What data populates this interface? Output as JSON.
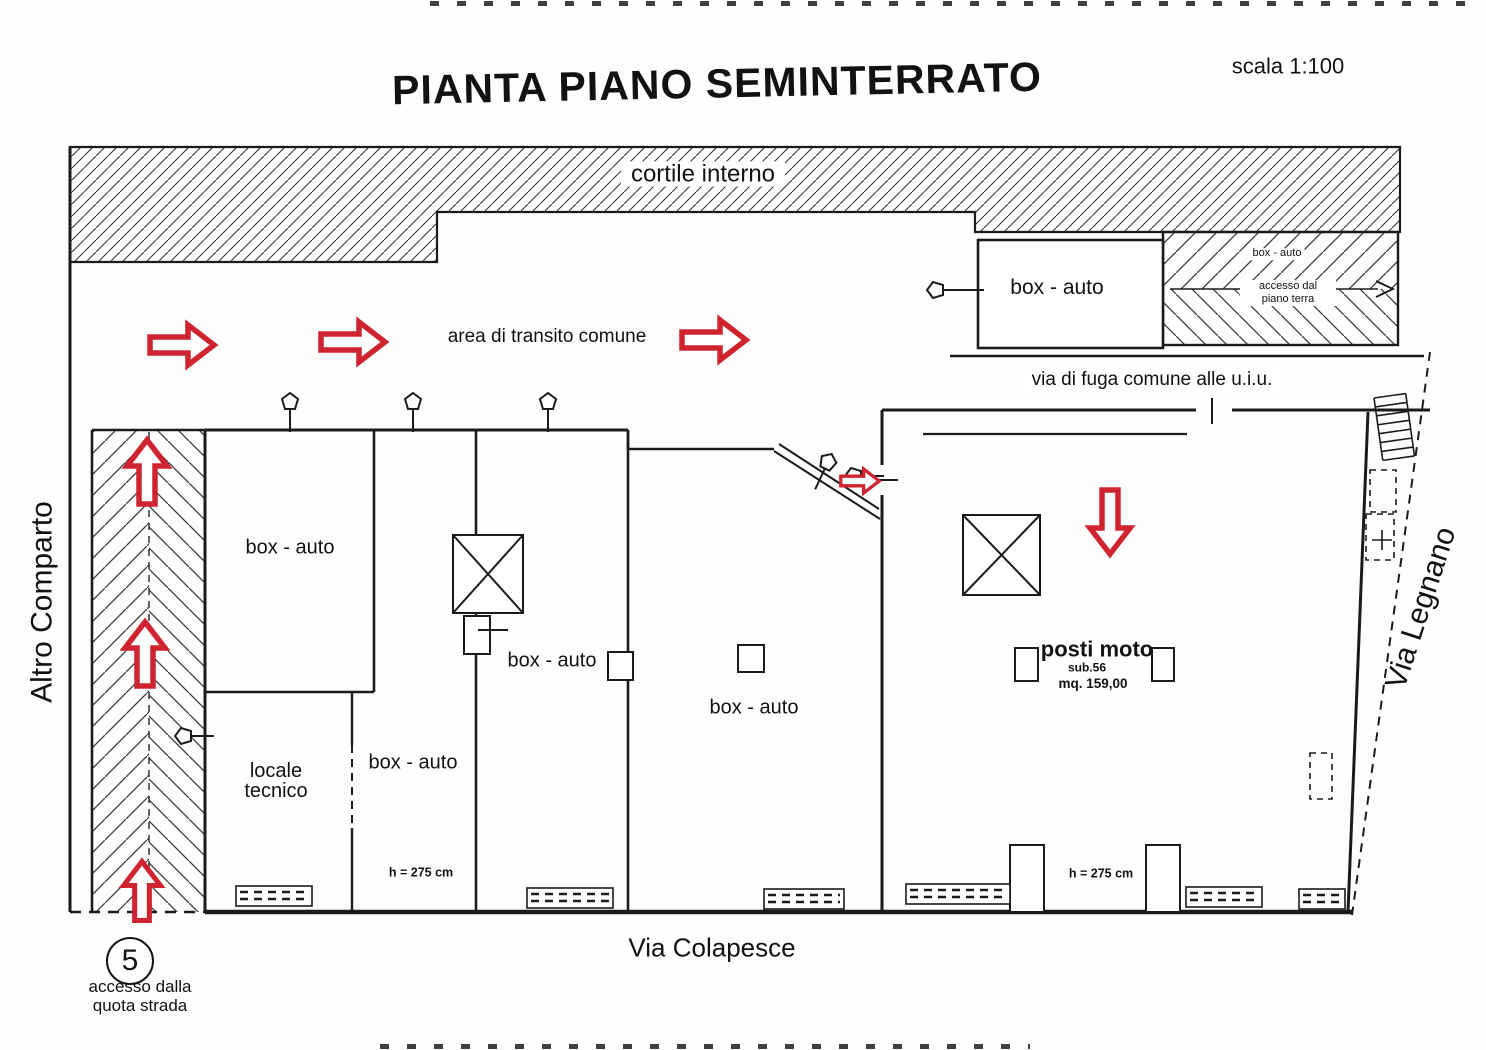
{
  "title": "PIANTA PIANO SEMINTERRATO",
  "scale": "scala 1:100",
  "labels": {
    "cortile": "cortile interno",
    "transito": "area di transito comune",
    "fuga": "via di fuga comune alle u.i.u.",
    "box_auto": "box - auto",
    "locale_line1": "locale",
    "locale_line2": "tecnico",
    "height": "h = 275 cm",
    "posti_moto": "posti moto",
    "posti_sub": "sub.56",
    "posti_mq": "mq. 159,00",
    "ramp_box": "box - auto",
    "ramp_access_line1": "accesso dal",
    "ramp_access_line2": "piano terra"
  },
  "streets": {
    "left": "Altro Comparto",
    "right": "Via Legnano",
    "bottom": "Via Colapesce"
  },
  "access": {
    "number": "5",
    "line1": "accesso dalla",
    "line2": "quota strada"
  },
  "colors": {
    "arrow_red": "#cf2430",
    "ink": "#1b1b1b"
  }
}
